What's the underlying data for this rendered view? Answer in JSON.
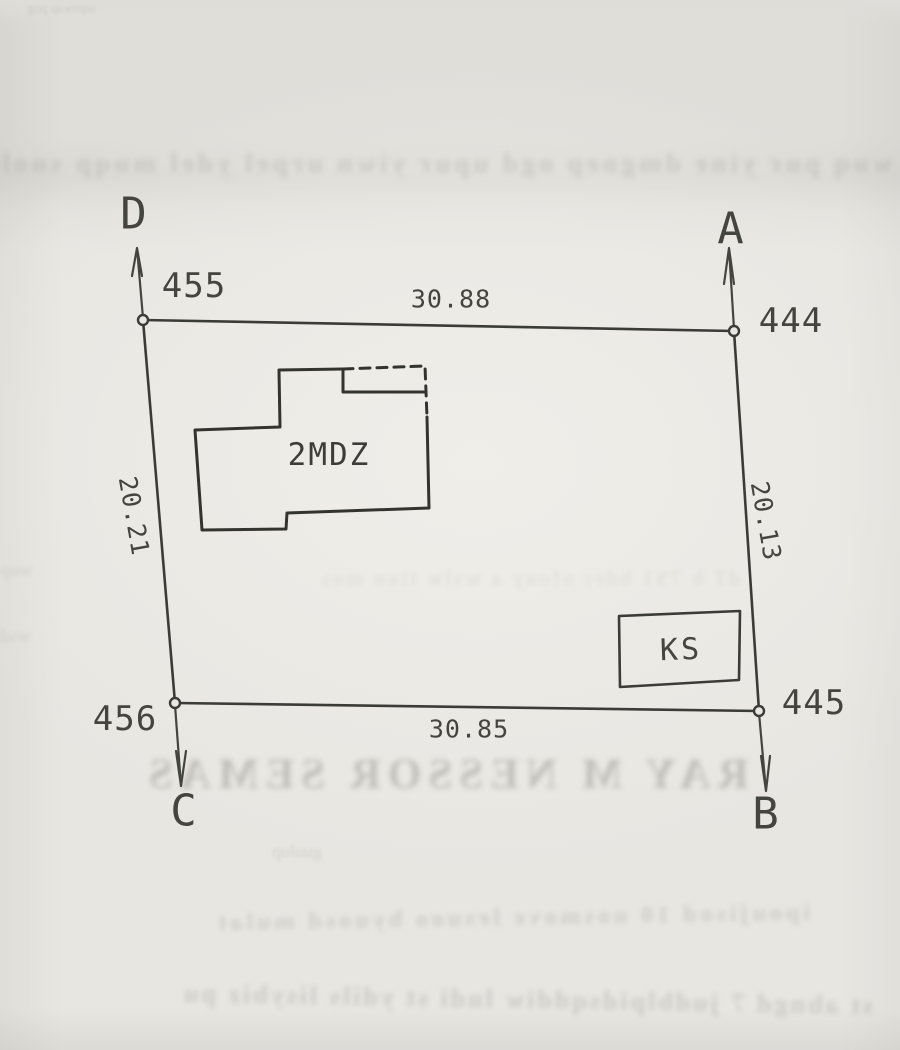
{
  "colors": {
    "paper": "#e8e6e1",
    "ink": "#3b3b37",
    "label_ink": "#45453f",
    "bleedthrough_ink": "#8d8a82"
  },
  "parcel": {
    "corner_letters": {
      "top_left": "D",
      "top_right": "A",
      "bottom_right": "B",
      "bottom_left": "C"
    },
    "point_numbers": {
      "top_left": "455",
      "top_right": "444",
      "bottom_right": "445",
      "bottom_left": "456"
    },
    "side_lengths": {
      "top": "30.88",
      "right": "20.13",
      "bottom": "30.85",
      "left": "20.21"
    },
    "building_label": "2MDZ",
    "outbuilding_label": "KS"
  },
  "bleedthrough_lines": [
    {
      "text": "uqmwap pog"
    },
    {
      "text": "wuq pur yine dmgnep ogd upur yiwn urpel ydel muqp snolu watd"
    },
    {
      "text": "dT b 7S1 bder ofouy a wslw tiun mos"
    },
    {
      "text": "wup"
    },
    {
      "text": "wsd"
    },
    {
      "text": "RAY M NESSOR SEMAS"
    },
    {
      "text": "guulup"
    },
    {
      "text": "ipoujisod 10 nosmove lesuoo byuosd mulat"
    },
    {
      "text": "st abngd 7 judblpidsqddiw ludi st ydils lisybiz pu"
    }
  ]
}
